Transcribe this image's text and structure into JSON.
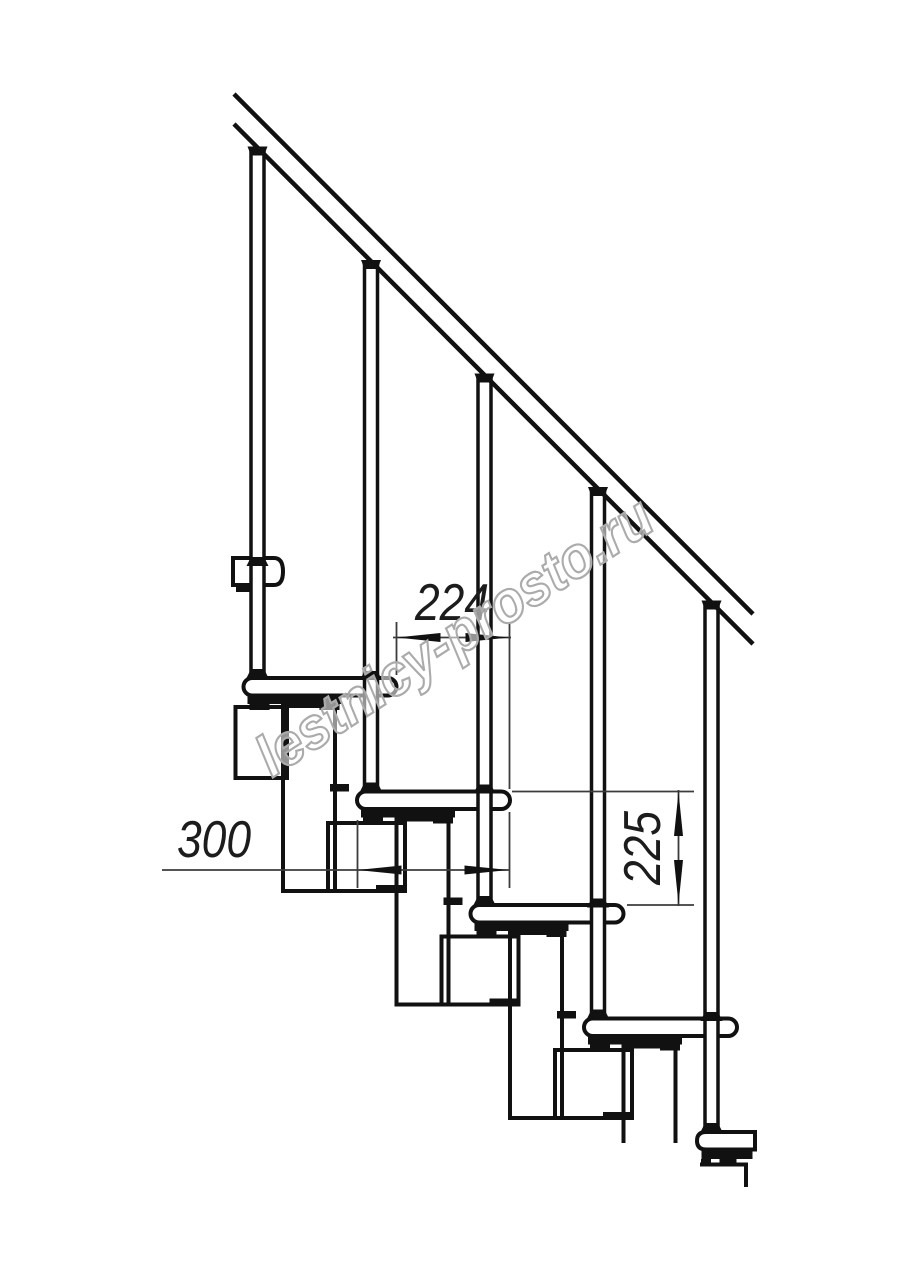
{
  "dimensions": {
    "going": "224",
    "tread_depth": "300",
    "rise": "225"
  },
  "watermark": {
    "text": "lestnicy-prosto.ru"
  },
  "colors": {
    "line": "#111111",
    "dim_line": "#3c3c3c",
    "arrow": "#111111",
    "watermark_stroke": "#ababab",
    "background": "#ffffff"
  }
}
